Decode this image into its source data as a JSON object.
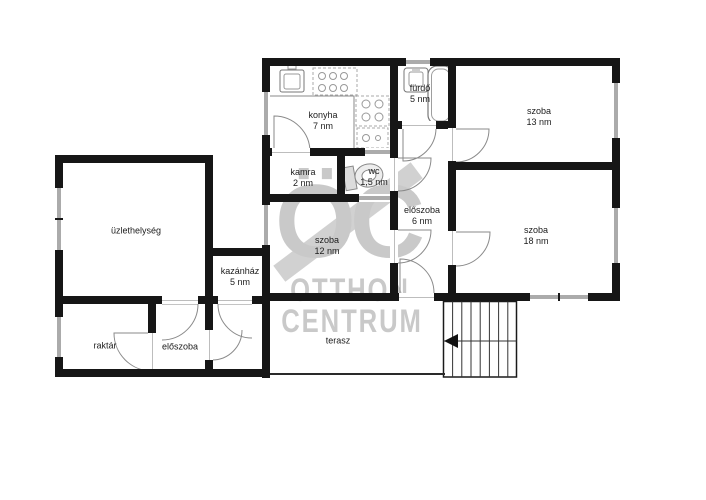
{
  "floorplan": {
    "rooms": [
      {
        "name": "konyha",
        "area": "7 nm"
      },
      {
        "name": "fürdő",
        "area": "5 nm"
      },
      {
        "name": "szoba",
        "area": "13 nm"
      },
      {
        "name": "kamra",
        "area": "2 nm"
      },
      {
        "name": "wc",
        "area": "1,5 nm"
      },
      {
        "name": "előszoba",
        "area": "6 nm"
      },
      {
        "name": "szoba",
        "area": "12 nm"
      },
      {
        "name": "szoba",
        "area": "18 nm"
      },
      {
        "name": "üzlethelység",
        "area": ""
      },
      {
        "name": "kazánház",
        "area": "5 nm"
      },
      {
        "name": "raktár",
        "area": ""
      },
      {
        "name": "előszoba",
        "area": ""
      },
      {
        "name": "terasz",
        "area": ""
      }
    ],
    "watermark": {
      "logo": "ÖC",
      "line1": "OTTHON",
      "line2": "CENTRUM"
    },
    "fixtures": [
      "kitchen-counter-icon",
      "stove-burners-icon",
      "kitchen-sink-icon",
      "washbasin-icon",
      "bathtub-icon",
      "toilet-icon",
      "staircase-icon"
    ],
    "colors": {
      "wall": "#161616",
      "window_glass": "#ababab",
      "door_arc": "#8a8a8a",
      "label_text": "#1c1c1c",
      "watermark": "#c9c9c9"
    }
  }
}
